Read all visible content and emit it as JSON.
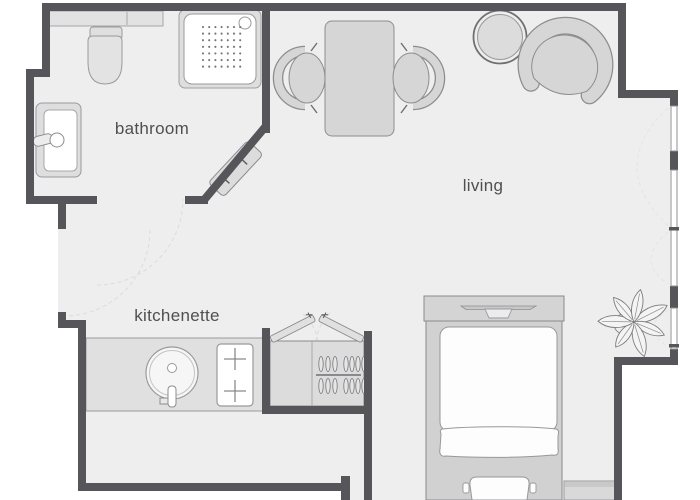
{
  "rooms": {
    "bathroom": {
      "label": "bathroom"
    },
    "living": {
      "label": "living"
    },
    "kitchenette": {
      "label": "kitchenette"
    }
  },
  "colors": {
    "wall": "#56565a",
    "floor": "#eeeeef",
    "furn": "#d6d6d7",
    "outline": "#8d8d90",
    "fixture": "#fdfdfd",
    "fixline": "#98989b",
    "label": "#4f4f4f",
    "bg": "#ffffff",
    "arc": "#dcdcdc"
  },
  "furniture_icons": [
    "wall-shelf",
    "toilet",
    "shower-tray",
    "bathroom-sink",
    "towel-radiator",
    "dining-table",
    "dining-chair-left",
    "dining-chair-right",
    "side-table",
    "armchair",
    "plant",
    "kitchen-counter",
    "kitchen-sink",
    "stove",
    "wardrobe",
    "clothes-hangers",
    "wardrobe-door-left",
    "wardrobe-door-right",
    "bed",
    "bed-bench",
    "duvet",
    "blanket",
    "pillow",
    "nightstand",
    "window-band",
    "door-swing-arc"
  ]
}
